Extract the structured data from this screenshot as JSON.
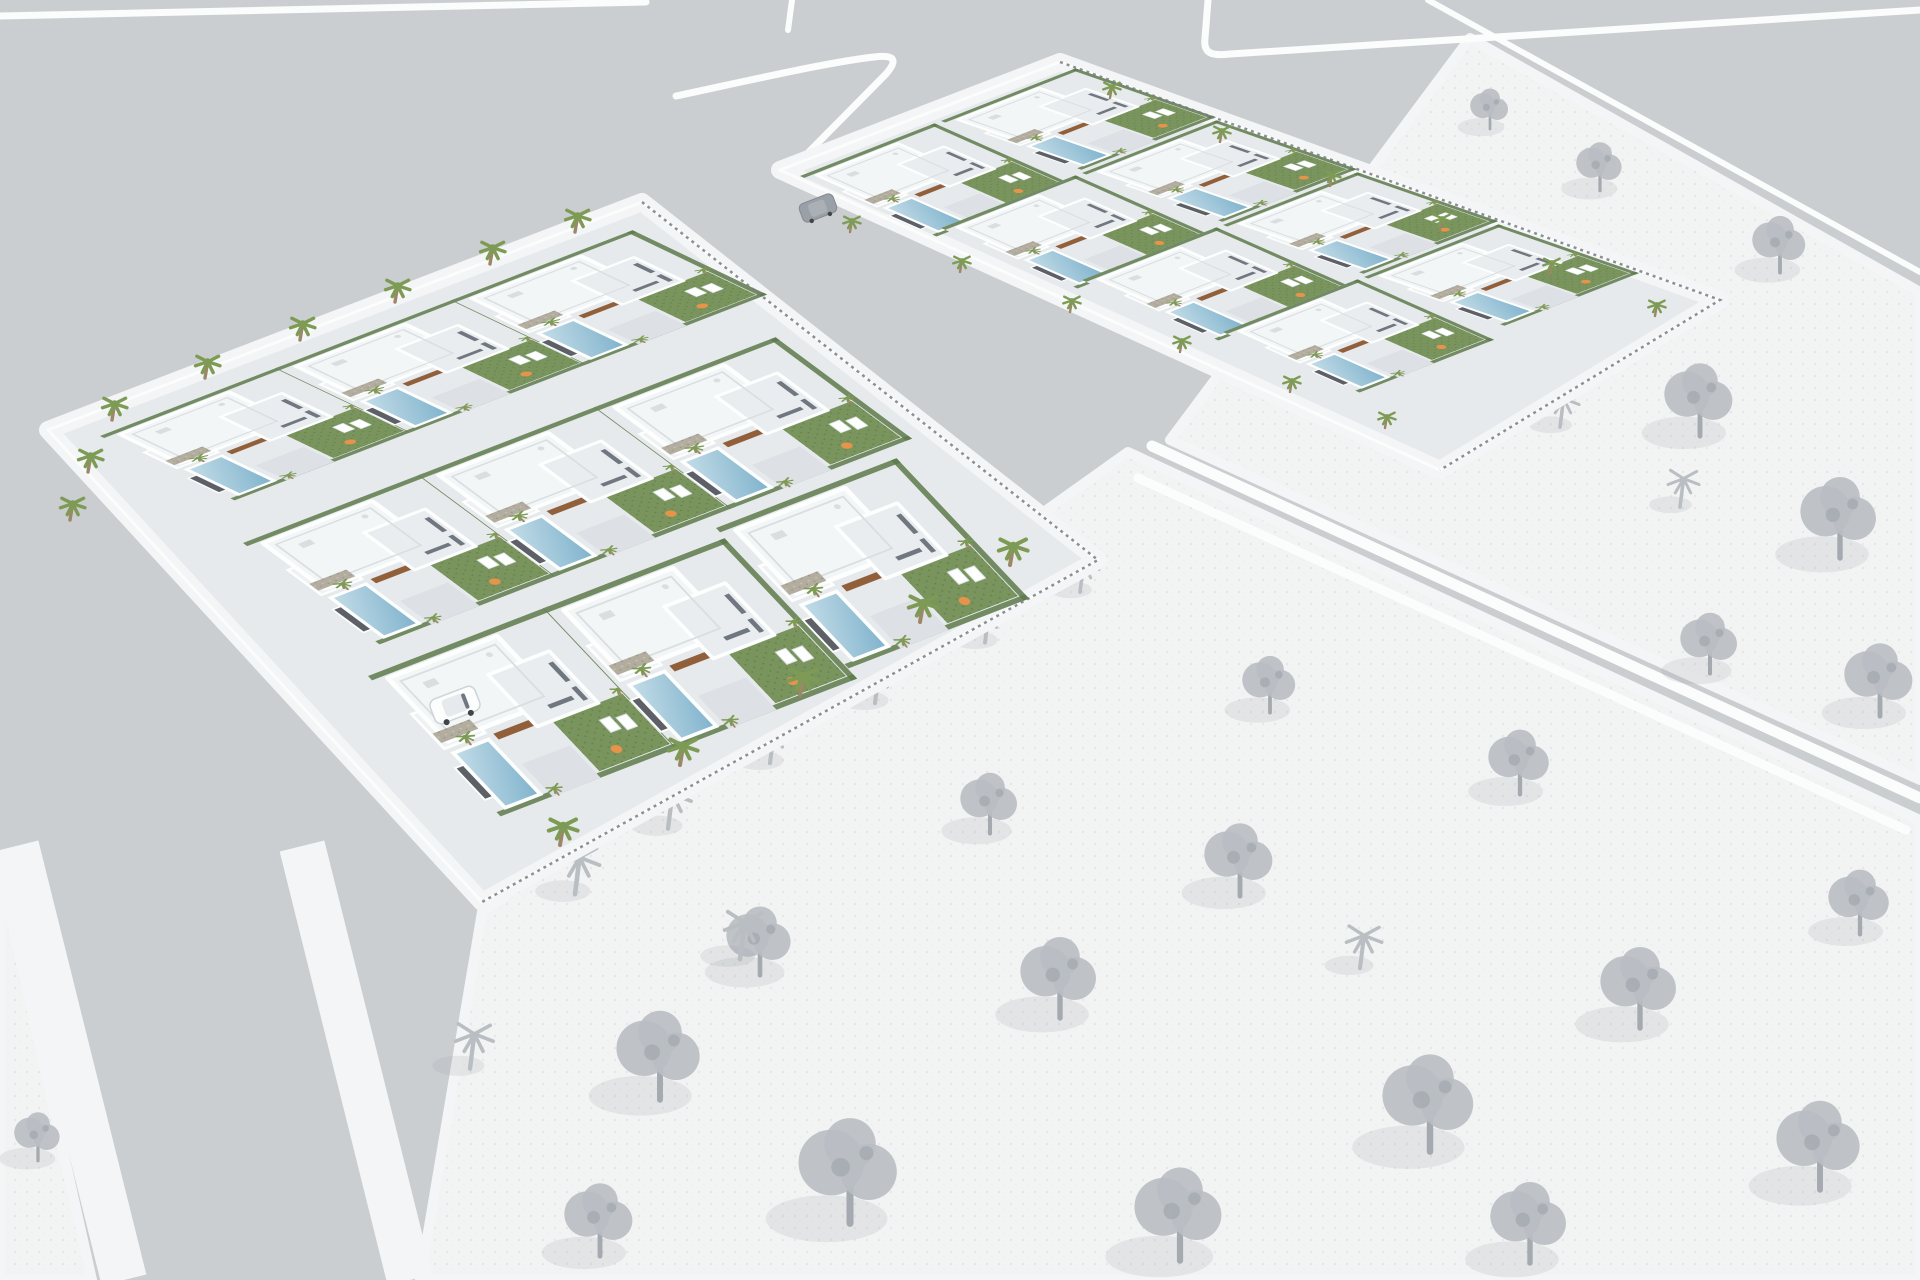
{
  "scene": {
    "title": "Aerial 3D architectural render of a residential villa development",
    "style": "photorealistic white modern villas on two developed parcels; surrounding undeveloped lots and vegetation shown in grayscale sketch style",
    "colors": {
      "road": "#cbced1",
      "road_line": "#fbfcfc",
      "sidewalk": "#f4f5f6",
      "land": "#f2f3f3",
      "land_dot": "#e3e5e6",
      "land_dot2": "#ececee",
      "paving": "#e7eaec",
      "drive": "#dde1e5",
      "terrace": "#eff1f3",
      "roof": "#f3f6f7",
      "roof2": "#e9edef",
      "parapet": "#fdfefe",
      "wall_shade": "#d9dee1",
      "stone": "#b3ada0",
      "stone_dot": "#c8c2b4",
      "stone_dot2": "#9e9789",
      "lawn": "#7a945e",
      "lawn_dot": "#66814c",
      "hedge": "#5d7a4b",
      "pool_light": "#c4dde8",
      "pool_deep": "#7fb2cc",
      "palm": "#7e9b55",
      "trunk": "#9c8766",
      "rust": "#91603b",
      "pouf": "#e8934a",
      "sketch": "#b9bec3",
      "sketch_dark": "#a4aab0",
      "fence": "#787d83",
      "gate": "#5d6167",
      "glass": "#707780",
      "car_white": "#fcfdfd",
      "car_dark": "#9aa0a7"
    },
    "parcels": [
      {
        "id": "main-parcel",
        "villas": 9,
        "pools": 9,
        "status": "rendered-in-color"
      },
      {
        "id": "north-parcel",
        "villas": 8,
        "pools": 8,
        "status": "rendered-in-color"
      }
    ],
    "context": {
      "open_lots": 3,
      "sketch_trees": 24,
      "sketch_palms": 11,
      "status": "grayscale-undeveloped"
    },
    "vehicles": {
      "white_car": 1,
      "dark_car": 1
    },
    "roads": {
      "marked_intersections": 1,
      "white_edge_lines": 7,
      "sidewalk_bands": 2
    }
  },
  "layout": {
    "road_lines": [
      {
        "d": "M0,16 L646,2",
        "w": 7
      },
      {
        "d": "M676,96 C760,78 830,62 874,57 C898,54 896,62 886,74 L797,164",
        "w": 7
      },
      {
        "d": "M1208,0 L1205,38 C1203,54 1212,56 1230,54 L1920,10",
        "w": 7
      },
      {
        "d": "M792,0 L788,30",
        "w": 6
      },
      {
        "d": "M1428,0 L1920,272",
        "w": 6
      },
      {
        "d": "M1152,446 L1920,798",
        "w": 11
      },
      {
        "d": "M1138,478 L1906,830",
        "w": 9
      }
    ],
    "sidewalk_bands": [
      {
        "d": "M16,846 L124,1280",
        "w": 46
      },
      {
        "d": "M302,846 L410,1280",
        "w": 46
      }
    ],
    "open_lands": [
      "M482,912 L1128,452 L1920,820 L1920,1280 L420,1280 Z",
      "M1470,38 L1920,292 L1920,780 L1170,440 Z",
      "M0,868 L92,1280 L0,1280 Z"
    ],
    "parcels": [
      {
        "outline": "M48,430 L642,202 L1098,560 L482,902 Z",
        "fence": "M642,202 L1098,560 L482,902",
        "rows": [
          {
            "m": [
              0.926,
              -0.358,
              0.69,
              0.33
            ],
            "anchors": [
              [
                100,
                436
              ],
              [
                276,
                368
              ],
              [
                452,
                300
              ]
            ]
          },
          {
            "m": [
              0.926,
              -0.358,
              0.7,
              0.52
            ],
            "anchors": [
              [
                243,
                543
              ],
              [
                419,
                475
              ],
              [
                595,
                407
              ]
            ]
          },
          {
            "m": [
              0.926,
              -0.358,
              0.68,
              0.72
            ],
            "anchors": [
              [
                368,
                676
              ],
              [
                544,
                608
              ],
              [
                716,
                528
              ]
            ]
          }
        ]
      },
      {
        "outline": "M780,170 L1060,62 L1720,300 L1440,470 Z",
        "fence": "M1060,62 L1720,300 L1440,470",
        "rows": [
          {
            "m": [
              0.69,
              -0.27,
              0.7,
              0.31
            ],
            "anchors": [
              [
                800,
                176
              ],
              [
                941,
                228
              ],
              [
                1082,
                280
              ],
              [
                1223,
                332
              ]
            ]
          },
          {
            "m": [
              0.69,
              -0.27,
              0.72,
              0.25
            ],
            "anchors": [
              [
                941,
                121
              ],
              [
                1082,
                173
              ],
              [
                1223,
                225
              ],
              [
                1364,
                277
              ]
            ]
          }
        ]
      }
    ],
    "green_palms": [
      {
        "s": 0.85,
        "pts": [
          [
            112,
            420
          ],
          [
            205,
            378
          ],
          [
            300,
            340
          ],
          [
            395,
            302
          ],
          [
            490,
            264
          ],
          [
            575,
            232
          ],
          [
            88,
            472
          ],
          [
            70,
            520
          ]
        ]
      },
      {
        "s": 1.0,
        "pts": [
          [
            560,
            845
          ],
          [
            680,
            765
          ],
          [
            800,
            695
          ],
          [
            920,
            622
          ],
          [
            1010,
            565
          ]
        ]
      },
      {
        "s": 0.6,
        "pts": [
          [
            850,
            232
          ],
          [
            960,
            272
          ],
          [
            1070,
            312
          ],
          [
            1180,
            352
          ],
          [
            1290,
            392
          ],
          [
            1385,
            428
          ],
          [
            1110,
            98
          ],
          [
            1220,
            142
          ],
          [
            1330,
            186
          ],
          [
            1440,
            230
          ],
          [
            1550,
            274
          ],
          [
            1655,
            316
          ]
        ]
      }
    ],
    "sketch_trees": [
      [
        660,
        1080,
        1.1
      ],
      [
        850,
        1200,
        1.3
      ],
      [
        1060,
        1000,
        1.0
      ],
      [
        1240,
        880,
        0.9
      ],
      [
        1430,
        1130,
        1.2
      ],
      [
        1640,
        1010,
        1.0
      ],
      [
        1820,
        1170,
        1.1
      ],
      [
        1520,
        780,
        0.8
      ],
      [
        1710,
        660,
        0.75
      ],
      [
        1270,
        700,
        0.7
      ],
      [
        990,
        820,
        0.75
      ],
      [
        600,
        1240,
        0.9
      ],
      [
        1860,
        920,
        0.8
      ],
      [
        1180,
        1240,
        1.15
      ],
      [
        1530,
        1245,
        1.0
      ],
      [
        760,
        960,
        0.85
      ],
      [
        1540,
        330,
        0.8
      ],
      [
        1700,
        420,
        0.9
      ],
      [
        1840,
        540,
        1.0
      ],
      [
        1600,
        180,
        0.6
      ],
      [
        1780,
        260,
        0.7
      ],
      [
        1880,
        700,
        0.9
      ],
      [
        1490,
        120,
        0.5
      ],
      [
        38,
        1150,
        0.6
      ]
    ],
    "sketch_palms": [
      [
        575,
        885,
        0.9
      ],
      [
        668,
        820,
        0.85
      ],
      [
        770,
        755,
        0.8
      ],
      [
        875,
        695,
        0.8
      ],
      [
        985,
        635,
        0.75
      ],
      [
        1080,
        585,
        0.7
      ],
      [
        740,
        950,
        0.9
      ],
      [
        1360,
        960,
        0.8
      ],
      [
        1560,
        420,
        0.7
      ],
      [
        1680,
        500,
        0.7
      ],
      [
        470,
        1060,
        0.85
      ]
    ]
  }
}
